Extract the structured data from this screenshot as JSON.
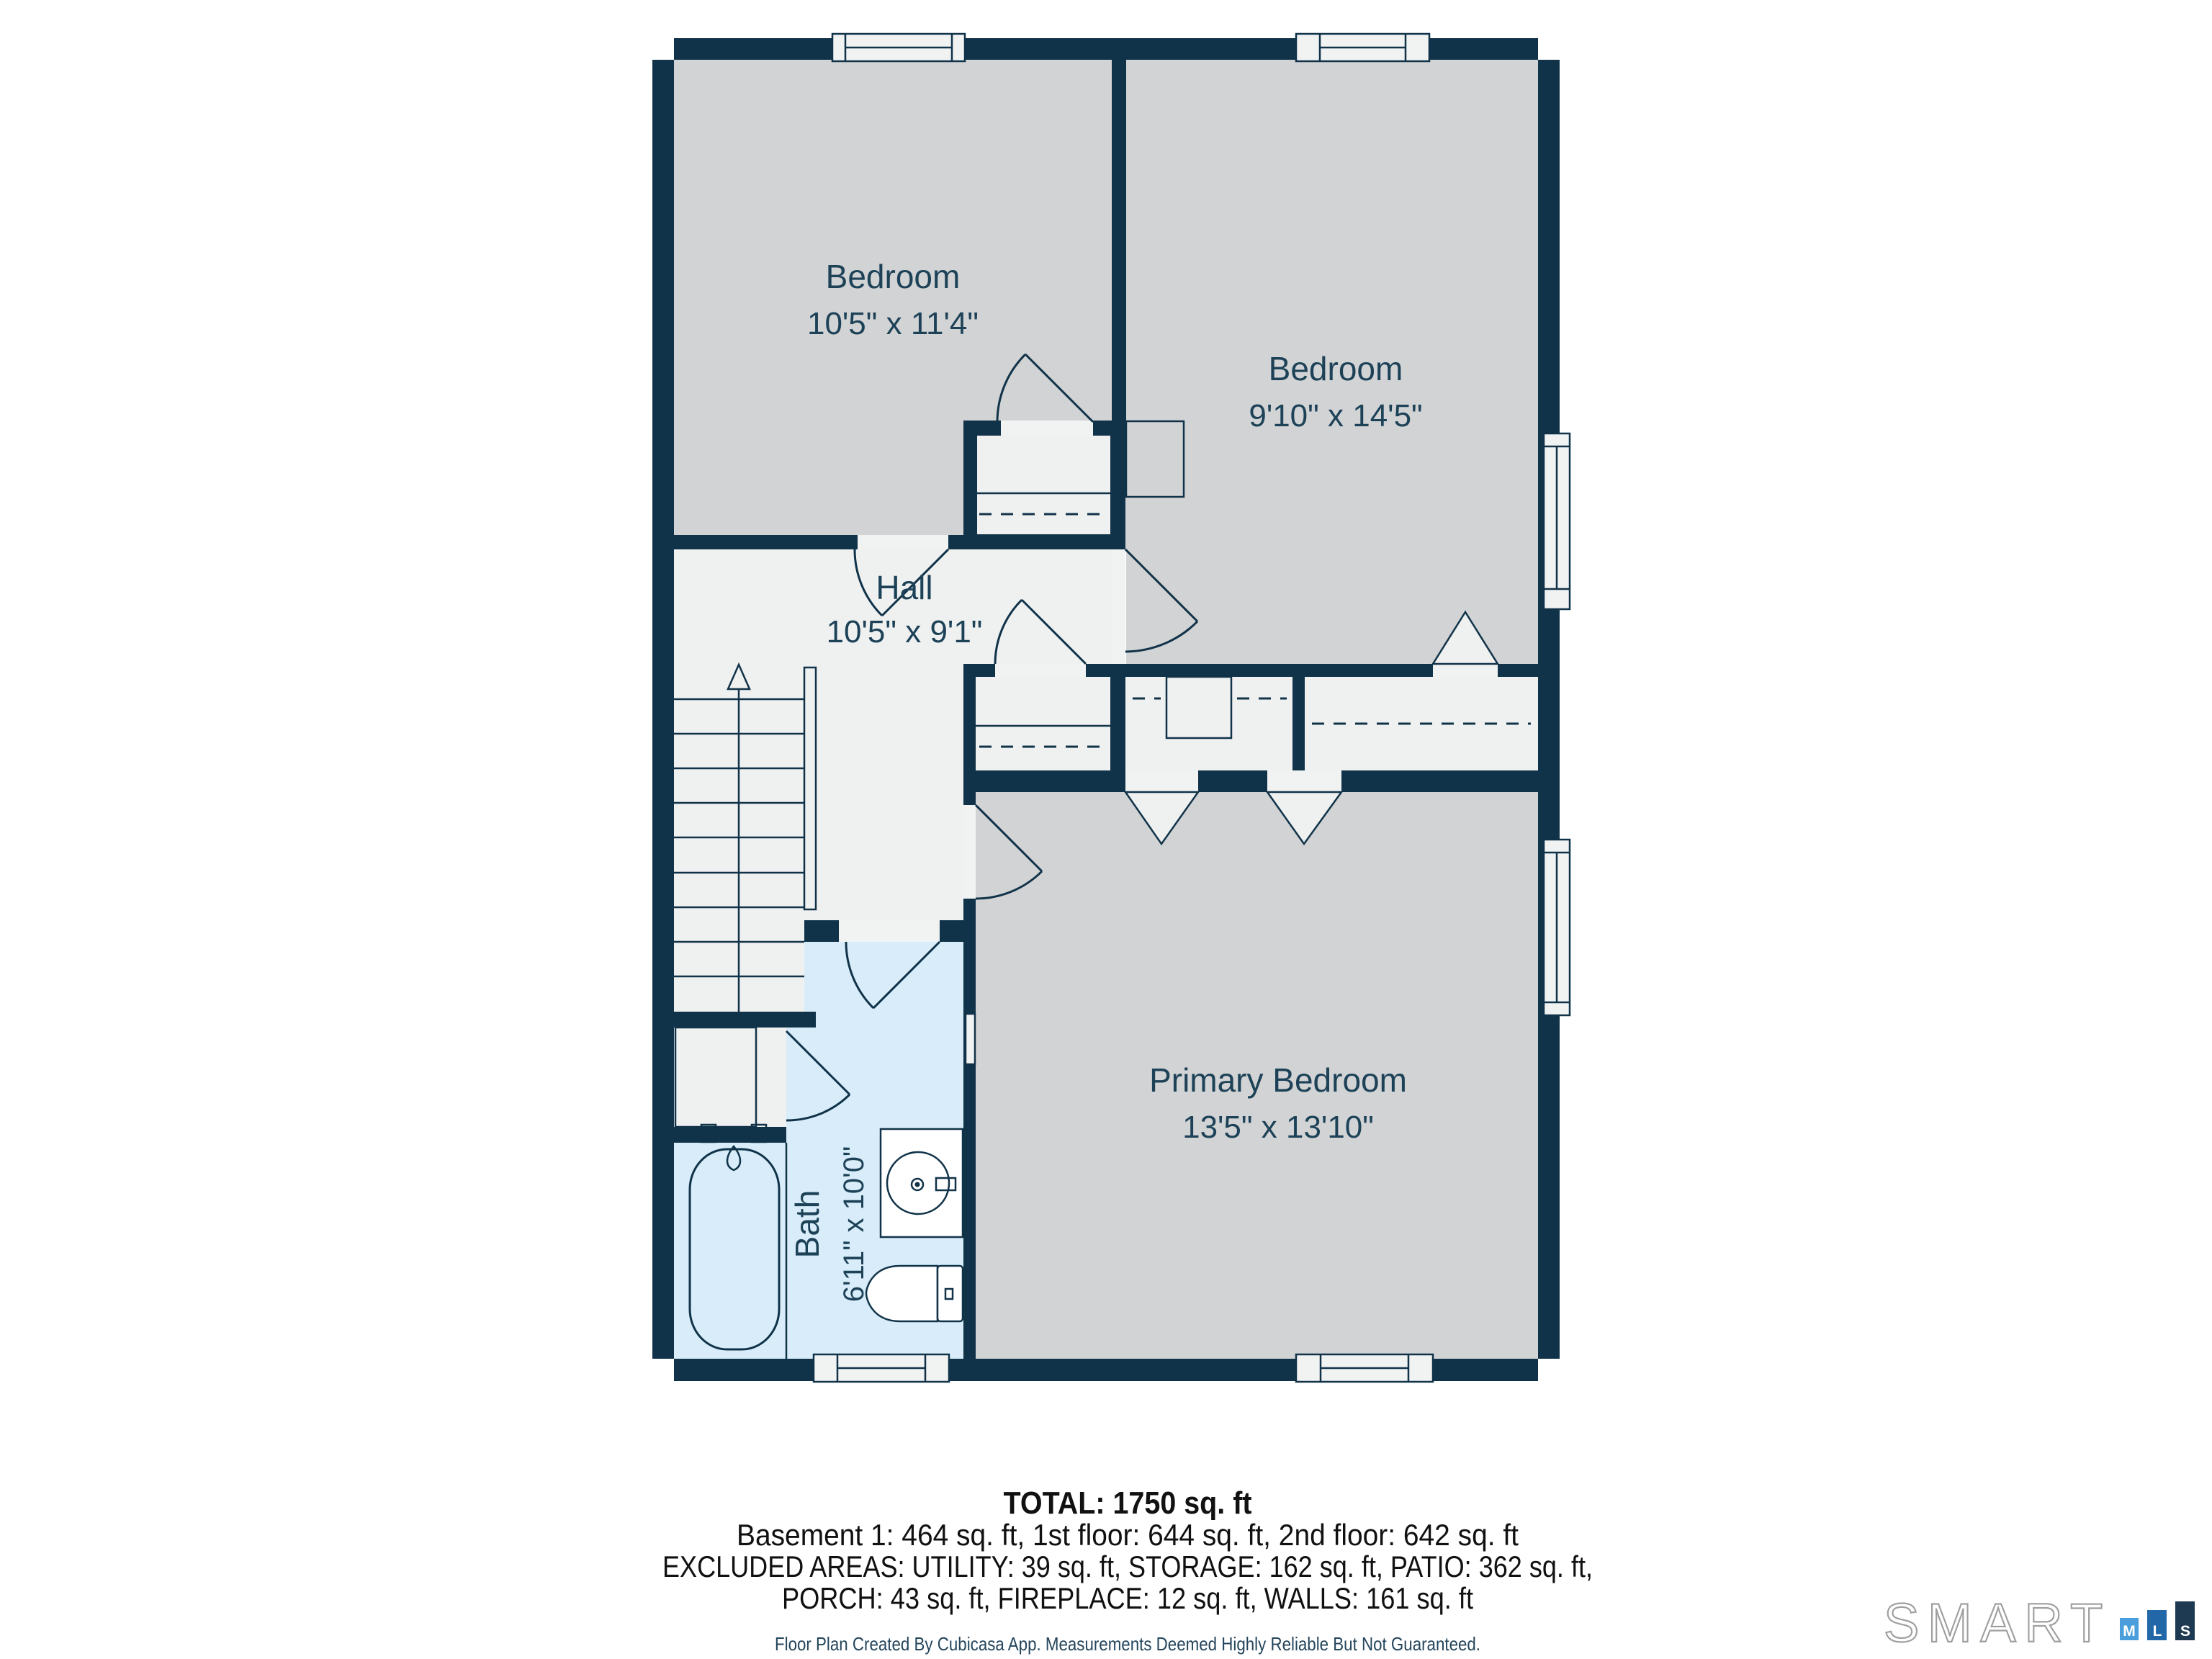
{
  "plan": {
    "rooms": [
      {
        "id": "bedroom-1",
        "name": "Bedroom",
        "dims": "10'5\" x 11'4\""
      },
      {
        "id": "bedroom-2",
        "name": "Bedroom",
        "dims": "9'10\" x 14'5\""
      },
      {
        "id": "hall",
        "name": "Hall",
        "dims": "10'5\" x 9'1\""
      },
      {
        "id": "primary-bedroom",
        "name": "Primary Bedroom",
        "dims": "13'5\" x 13'10\""
      },
      {
        "id": "bath",
        "name": "Bath",
        "dims": "6'11\" x 10'0\""
      }
    ],
    "features": [
      "stairs-up",
      "closets-with-hanging-rails",
      "bathtub",
      "sink-vanity",
      "toilet",
      "6-windows"
    ]
  },
  "summary": {
    "total": "TOTAL: 1750 sq. ft",
    "lines": [
      "Basement 1: 464 sq. ft, 1st floor: 644 sq. ft, 2nd floor: 642 sq. ft",
      "EXCLUDED AREAS: UTILITY: 39 sq. ft, STORAGE: 162 sq. ft, PATIO: 362 sq. ft,",
      "PORCH: 43 sq. ft, FIREPLACE: 12 sq. ft, WALLS: 161 sq. ft"
    ],
    "disclaimer": "Floor Plan Created By Cubicasa App. Measurements Deemed Highly Reliable But Not Guaranteed."
  },
  "logo": {
    "brand": "SMART",
    "tiles": [
      "M",
      "L",
      "S"
    ]
  },
  "colors": {
    "wall": "#113349",
    "bedroom_fill": "#d2d3d4",
    "hall_fill": "#eff0f0",
    "bath_fill": "#d8edf9",
    "window_fill": "#f1f3f3",
    "label": "#1d4258",
    "summary_text": "#111111",
    "disclaimer_text": "#24455c",
    "logo_outline": "#9f9f9f",
    "logo_m": "#4a9edb",
    "logo_l": "#2268a9",
    "logo_s": "#1d3a52"
  }
}
